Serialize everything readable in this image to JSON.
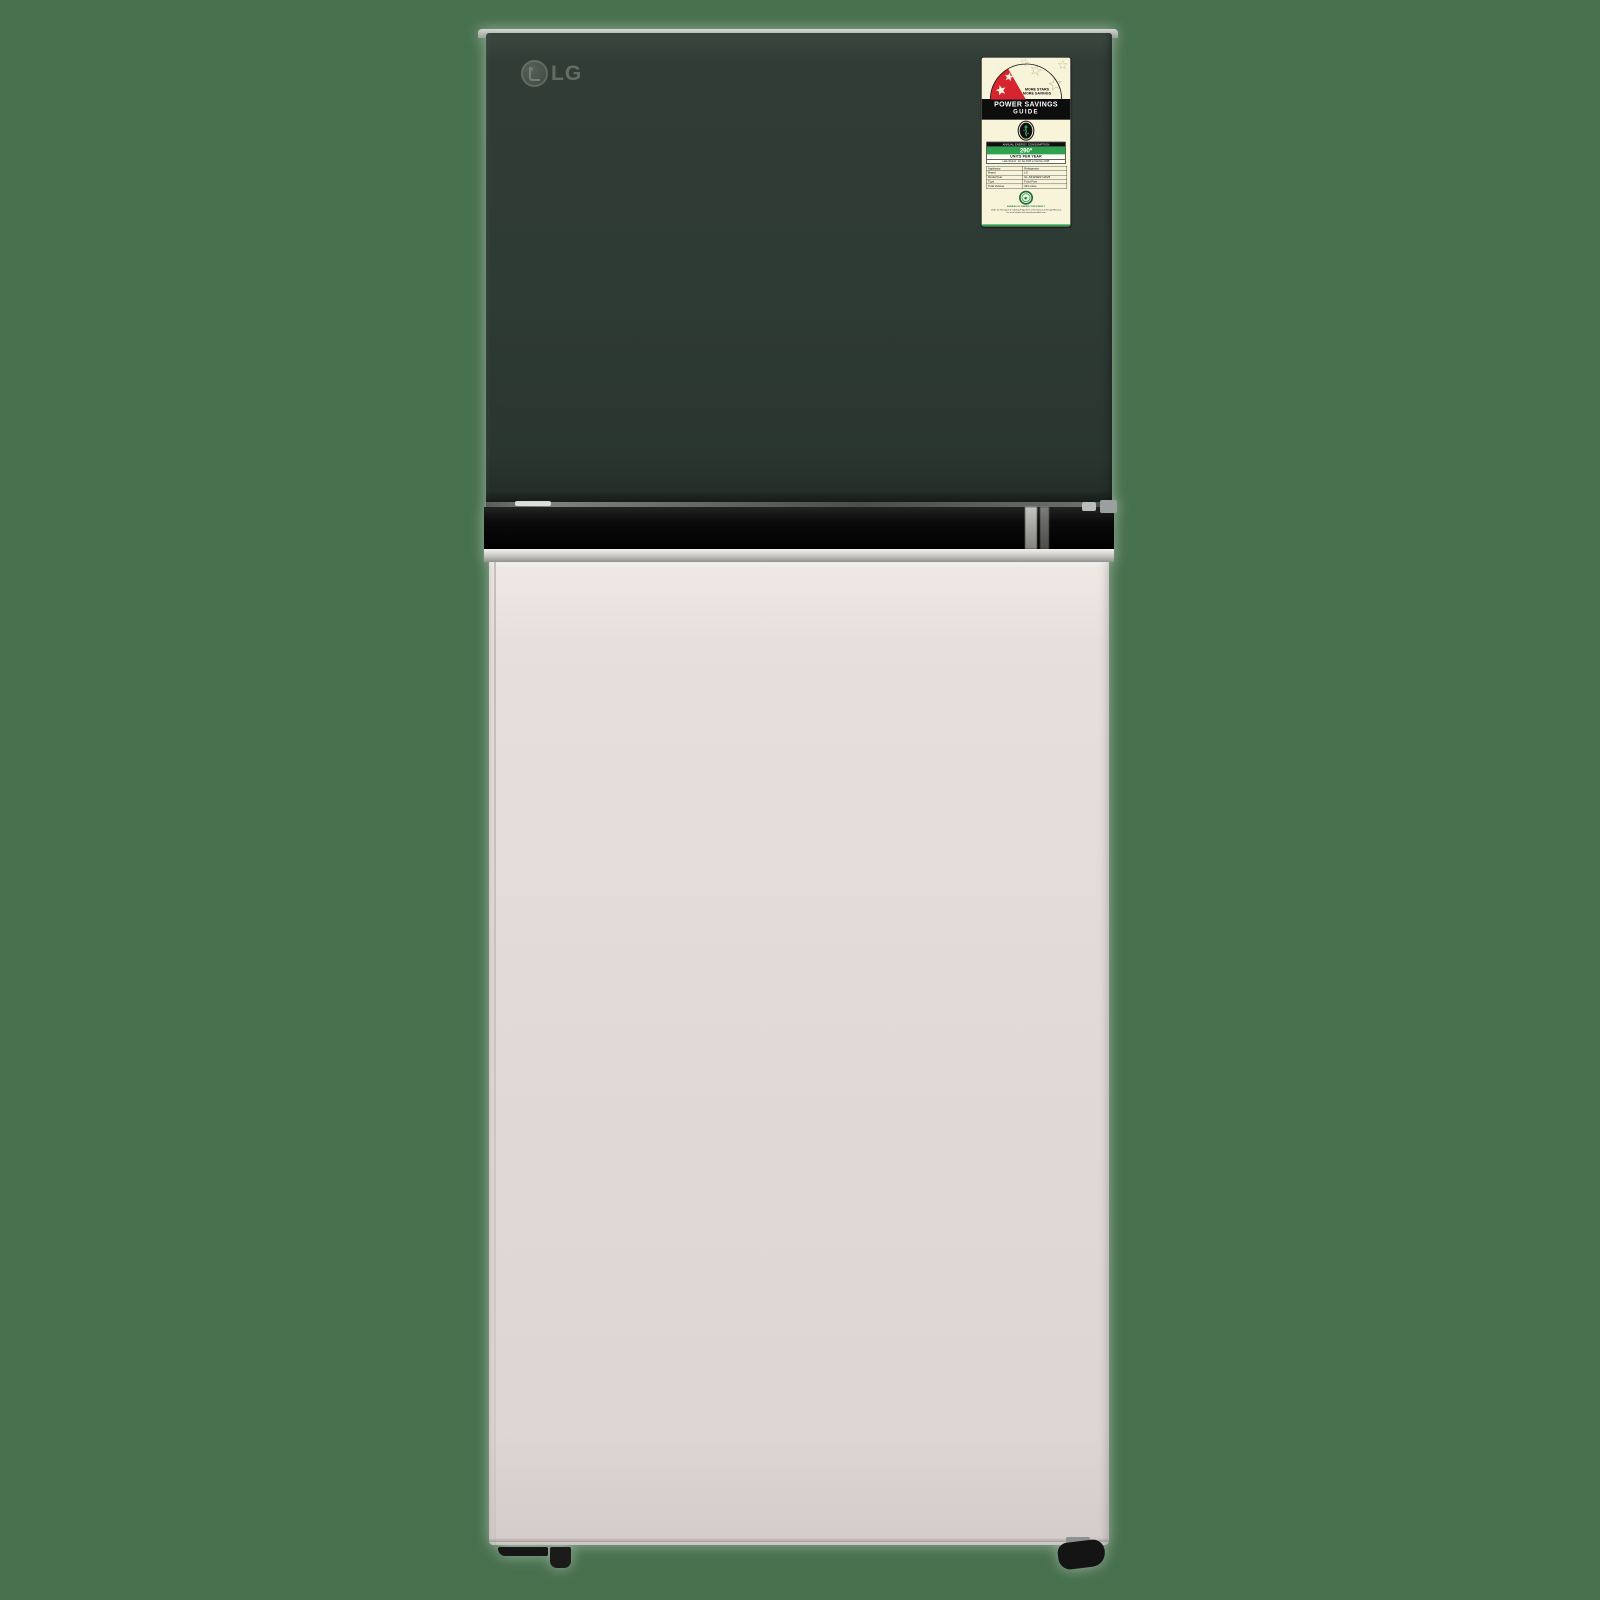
{
  "product": {
    "brand_logo": "LG",
    "background_color": "#47704d",
    "freezer_door_color": "#2e3a34",
    "fridge_door_color": "#e0d8d6",
    "trim_black": "#0b0b0b",
    "trim_silver": "#c9c8c4"
  },
  "energy_label": {
    "label_bg": "#f7f4da",
    "accent_red": "#d6252e",
    "accent_green": "#2fa24f",
    "tagline_line1": "MORE STARS",
    "tagline_line2": "MORE SAVINGS",
    "title_line1": "POWER SAVINGS",
    "title_line2": "GUIDE",
    "consumption_header": "ANNUAL ENERGY CONSUMPTION",
    "consumption_value": "290*",
    "consumption_unit": "UNITS PER YEAR",
    "label_period": "Label Period : 1st Jan 2025 to 31st Dec 2025",
    "table": {
      "rows": [
        {
          "label": "Appliance",
          "value": "Refrigerator"
        },
        {
          "label": "Brand",
          "value": "LG"
        },
        {
          "label": "Model/Year",
          "value": "GL-S432SESY/2025"
        },
        {
          "label": "Type",
          "value": "Frost Free"
        },
        {
          "label": "Total Volume",
          "value": "343 Litres"
        }
      ]
    },
    "authority": "BUREAU OF ENERGY EFFICIENCY",
    "footnote_line1": "Under the Standards & Labeling Programme of the Bureau of Energy Efficiency",
    "footnote_line2": "For more details visit www.beestarlabel.com"
  }
}
